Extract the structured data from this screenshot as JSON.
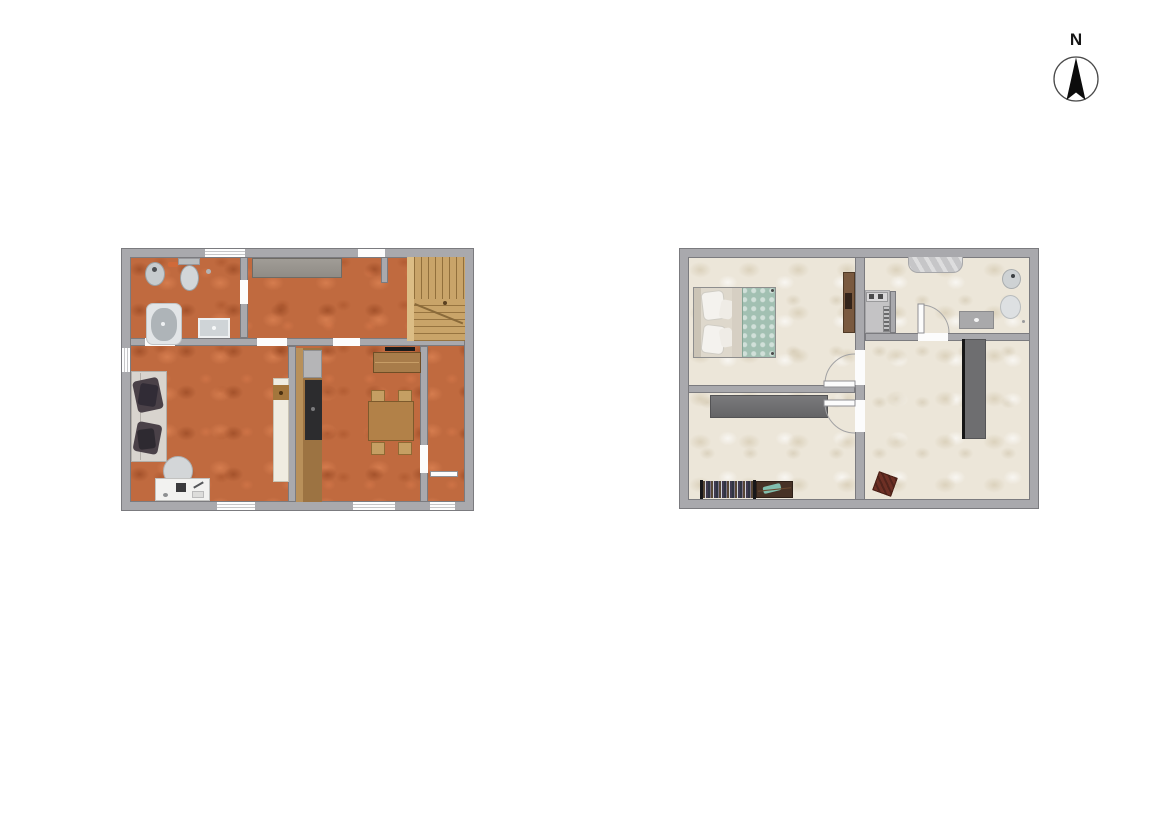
{
  "compass": {
    "label": "N"
  },
  "palette": {
    "background": "#ffffff",
    "wall_fill": "#a9a9ad",
    "wall_edge": "#7b7b7f",
    "ground_floor_tile": "#c06a3f",
    "upper_floor_tile": "#ece6d9",
    "stair_wood": "#c9a469",
    "furniture_wood": "#a87c4a",
    "sofa_fabric": "#d8d4ce",
    "pillow_dark": "#4a4148",
    "bed_blanket_teal": "#a2c0b2",
    "wardrobe_gray": "#6e6e70",
    "sanitary_gray": "#ccd1d4",
    "stool_redwood": "#6e3025"
  },
  "floor_plans": [
    {
      "name": "ground-floor-plan",
      "floor_color": "#c06a3f",
      "rooms": [
        {
          "name": "bathroom",
          "furniture": [
            "bidet",
            "toilet",
            "bathtub",
            "washbasin"
          ]
        },
        {
          "name": "hallway",
          "furniture": [
            "wardrobe",
            "staircase"
          ]
        },
        {
          "name": "living-room",
          "furniture": [
            "sofa",
            "chair",
            "desk",
            "tall-cabinet"
          ]
        },
        {
          "name": "kitchen-dining-room",
          "furniture": [
            "kitchen-counter",
            "sideboard",
            "dining-table",
            "four-chairs"
          ]
        },
        {
          "name": "corridor",
          "furniture": []
        }
      ]
    },
    {
      "name": "upper-floor-plan",
      "floor_color": "#ece6d9",
      "rooms": [
        {
          "name": "bedroom",
          "furniture": [
            "double-bed",
            "wardrobe"
          ]
        },
        {
          "name": "bathroom",
          "furniture": [
            "shower-tub",
            "toilet",
            "bidet",
            "vanity-sink",
            "desk-nook",
            "radiator"
          ]
        },
        {
          "name": "second-bedroom",
          "furniture": [
            "wardrobe",
            "clothes-rack"
          ]
        },
        {
          "name": "studio-room",
          "furniture": [
            "tall-cabinet",
            "stool"
          ]
        }
      ]
    }
  ]
}
